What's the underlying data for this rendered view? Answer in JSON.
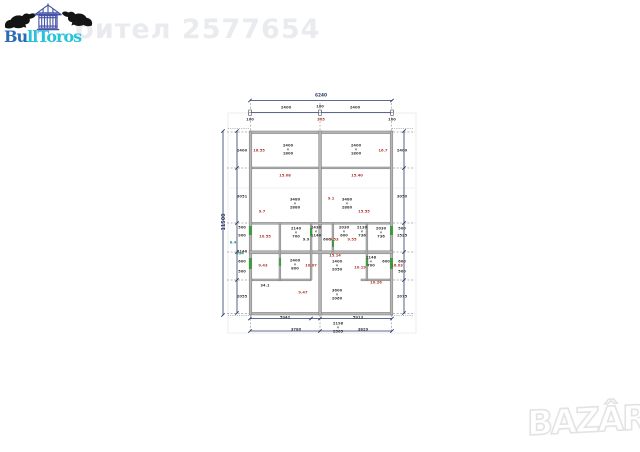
{
  "watermark": {
    "user_text": "бител 2577654"
  },
  "logo": {
    "brand_prefix": "Bu",
    "brand_suffix": "llToros"
  },
  "bazar": {
    "text": "BAZÂR"
  },
  "plan": {
    "title": "duplex-house-floor-plan",
    "colors": {
      "wall_fill": "#b5b5b5",
      "wall_edge": "#7a7a7a",
      "dimension_line": "#2a3a66",
      "area_label": "#b03a30",
      "teal_label": "#2e8b8b",
      "door_mark": "#3c9b3c"
    },
    "overall_width": "6240",
    "overall_height": "11500",
    "labels": [
      {
        "x": 321,
        "y": 96,
        "text": "6240",
        "c": "n"
      },
      {
        "x": 286,
        "y": 108,
        "text": "2400",
        "c": "k"
      },
      {
        "x": 355,
        "y": 108,
        "text": "2400",
        "c": "k"
      },
      {
        "x": 250,
        "y": 120,
        "text": "100",
        "c": "k"
      },
      {
        "x": 320,
        "y": 107,
        "text": "100",
        "c": "k"
      },
      {
        "x": 321,
        "y": 120,
        "text": "305",
        "c": "r"
      },
      {
        "x": 392,
        "y": 120,
        "text": "100",
        "c": "k"
      },
      {
        "x": 224,
        "y": 222,
        "text": "11500",
        "c": "n",
        "rot": true
      },
      {
        "x": 242,
        "y": 151,
        "text": "2400",
        "c": "k"
      },
      {
        "x": 242,
        "y": 197,
        "text": "3051",
        "c": "k"
      },
      {
        "x": 242,
        "y": 228,
        "text": "500",
        "c": "k"
      },
      {
        "x": 242,
        "y": 236,
        "text": "900",
        "c": "k"
      },
      {
        "x": 242,
        "y": 252,
        "text": "1140",
        "c": "k"
      },
      {
        "x": 242,
        "y": 262,
        "text": "600",
        "c": "k"
      },
      {
        "x": 242,
        "y": 272,
        "text": "500",
        "c": "k"
      },
      {
        "x": 242,
        "y": 297,
        "text": "2055",
        "c": "k"
      },
      {
        "x": 402,
        "y": 151,
        "text": "2400",
        "c": "k"
      },
      {
        "x": 402,
        "y": 197,
        "text": "3050",
        "c": "k"
      },
      {
        "x": 402,
        "y": 229,
        "text": "500",
        "c": "k"
      },
      {
        "x": 402,
        "y": 236,
        "text": "1525",
        "c": "k"
      },
      {
        "x": 402,
        "y": 262,
        "text": "600",
        "c": "k"
      },
      {
        "x": 402,
        "y": 272,
        "text": "500",
        "c": "k"
      },
      {
        "x": 402,
        "y": 297,
        "text": "2075",
        "c": "k"
      },
      {
        "x": 288,
        "y": 150,
        "text": "2400\n×\n1800",
        "c": "k"
      },
      {
        "x": 356,
        "y": 150,
        "text": "2400\n×\n1800",
        "c": "k"
      },
      {
        "x": 259,
        "y": 151,
        "text": "16.55",
        "c": "r"
      },
      {
        "x": 383,
        "y": 151,
        "text": "16.7",
        "c": "r"
      },
      {
        "x": 285,
        "y": 176,
        "text": "15.08",
        "c": "r"
      },
      {
        "x": 357,
        "y": 176,
        "text": "15.40",
        "c": "r"
      },
      {
        "x": 295,
        "y": 204,
        "text": "3480\n×\n2880",
        "c": "k"
      },
      {
        "x": 347,
        "y": 204,
        "text": "3480\n×\n2880",
        "c": "k"
      },
      {
        "x": 331,
        "y": 199,
        "text": "9.1",
        "c": "r"
      },
      {
        "x": 262,
        "y": 212,
        "text": "9.7",
        "c": "r"
      },
      {
        "x": 364,
        "y": 212,
        "text": "15.55",
        "c": "r"
      },
      {
        "x": 265,
        "y": 237,
        "text": "10.55",
        "c": "r"
      },
      {
        "x": 296,
        "y": 233,
        "text": "2140\n×\n700",
        "c": "k"
      },
      {
        "x": 306,
        "y": 240,
        "text": "9.9",
        "c": "k"
      },
      {
        "x": 316,
        "y": 232,
        "text": "2430\n×\n1146",
        "c": "k"
      },
      {
        "x": 327,
        "y": 240,
        "text": "600",
        "c": "k"
      },
      {
        "x": 334,
        "y": 240,
        "text": "9.53",
        "c": "r"
      },
      {
        "x": 344,
        "y": 232,
        "text": "2030\n×\n600",
        "c": "k"
      },
      {
        "x": 352,
        "y": 240,
        "text": "9.55",
        "c": "r"
      },
      {
        "x": 362,
        "y": 232,
        "text": "2130\n×\n736",
        "c": "k"
      },
      {
        "x": 381,
        "y": 233,
        "text": "2030\n×\n736",
        "c": "k"
      },
      {
        "x": 233,
        "y": 243,
        "text": "8.4",
        "c": "t"
      },
      {
        "x": 240,
        "y": 254,
        "text": "394",
        "c": "t"
      },
      {
        "x": 335,
        "y": 256,
        "text": "15.14",
        "c": "r"
      },
      {
        "x": 263,
        "y": 266,
        "text": "9.43",
        "c": "r"
      },
      {
        "x": 295,
        "y": 265,
        "text": "2400\n×\n800",
        "c": "k"
      },
      {
        "x": 311,
        "y": 266,
        "text": "10.07",
        "c": "r"
      },
      {
        "x": 337,
        "y": 266,
        "text": "1400\n×\n2050",
        "c": "k"
      },
      {
        "x": 360,
        "y": 268,
        "text": "10.19",
        "c": "r"
      },
      {
        "x": 371,
        "y": 262,
        "text": "2148\n×\n700",
        "c": "k"
      },
      {
        "x": 386,
        "y": 262,
        "text": "600",
        "c": "k"
      },
      {
        "x": 397,
        "y": 266,
        "text": "16.03",
        "c": "r"
      },
      {
        "x": 265,
        "y": 286,
        "text": "34.1",
        "c": "k"
      },
      {
        "x": 303,
        "y": 293,
        "text": "9.47",
        "c": "r"
      },
      {
        "x": 376,
        "y": 283,
        "text": "10.26",
        "c": "r"
      },
      {
        "x": 337,
        "y": 295,
        "text": "3600\n×\n2060",
        "c": "k"
      },
      {
        "x": 285,
        "y": 318,
        "text": "5942",
        "c": "k"
      },
      {
        "x": 358,
        "y": 318,
        "text": "5913",
        "c": "k"
      },
      {
        "x": 296,
        "y": 330,
        "text": "3780",
        "c": "k"
      },
      {
        "x": 338,
        "y": 328,
        "text": "2198\n×\n2565",
        "c": "k"
      },
      {
        "x": 363,
        "y": 330,
        "text": "3829",
        "c": "k"
      }
    ]
  }
}
